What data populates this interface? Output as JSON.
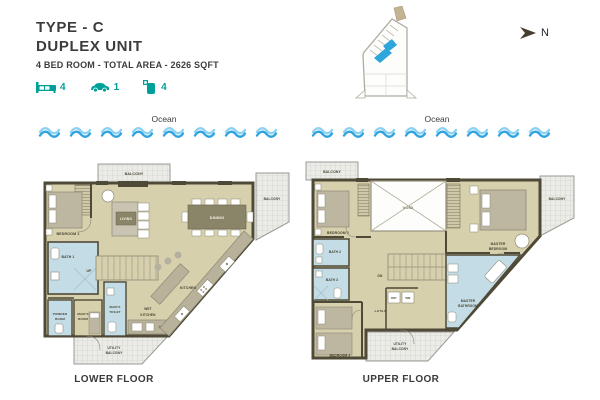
{
  "header": {
    "type_label": "TYPE - C",
    "unit_label": "DUPLEX UNIT",
    "spec_line": "4 BED ROOM - TOTAL AREA - 2626 SQFT",
    "stats": {
      "beds": "4",
      "cars": "1",
      "baths": "4"
    }
  },
  "compass": {
    "label": "N"
  },
  "ocean": {
    "label": "Ocean"
  },
  "floors": {
    "lower": {
      "title": "LOWER FLOOR",
      "labels": {
        "balcony_top": "BALCONY",
        "balcony_right": "BALCONY",
        "utility_balcony_1": "UTILITY",
        "utility_balcony_2": "BALCONY",
        "bedroom1": "BEDROOM 1",
        "living": "LIVING",
        "dining": "DINING",
        "bath1": "BATH 1",
        "powder_1": "POWDER",
        "powder_2": "ROOM",
        "maids_room_1": "MAID'S",
        "maids_room_2": "ROOM",
        "maids_toilet_1": "MAID'S",
        "maids_toilet_2": "TOILET",
        "wet_kitchen_1": "WET",
        "wet_kitchen_2": "KITCHEN",
        "kitchen": "KITCHEN",
        "up": "UP"
      }
    },
    "upper": {
      "title": "UPPER FLOOR",
      "labels": {
        "balcony_top": "BALCONY",
        "balcony_right": "BALCONY",
        "utility_balcony_1": "UTILITY",
        "utility_balcony_2": "BALCONY",
        "bedroom2": "BEDROOM 2",
        "bedroom3": "BEDROOM 3",
        "void": "VOID",
        "master_bedroom_1": "MASTER",
        "master_bedroom_2": "BEDROOM",
        "master_bathroom_1": "MASTER",
        "master_bathroom_2": "BATHROOM",
        "bath2": "BATH 2",
        "bath3": "BATH 3",
        "dn": "DN",
        "dry": "DRY",
        "wm": "WM",
        "utility": "UTILITY"
      }
    }
  },
  "colors": {
    "accent_teal": "#00a09a",
    "wave_blue": "#2fa3e0",
    "floor_beige": "#d7d0ad",
    "wall_dark": "#4f4937",
    "bath_blue": "#c4dce6"
  }
}
